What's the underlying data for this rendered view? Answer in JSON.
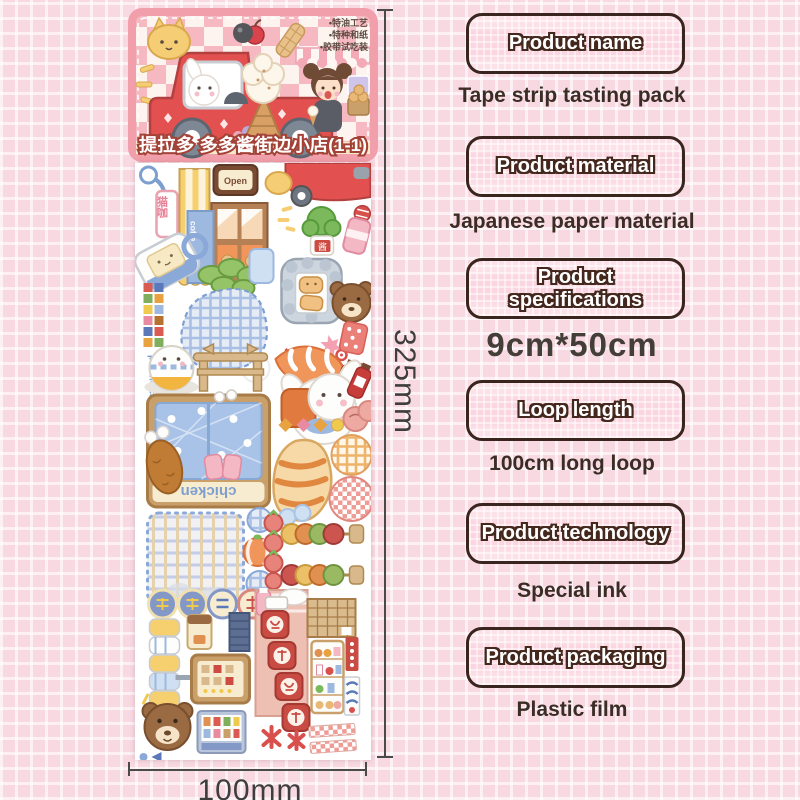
{
  "page": {
    "background": "#f8d9e2",
    "accent_pink": "#fbd6e0",
    "badge_border": "#3a241e",
    "text_brown": "#3b2d26"
  },
  "dimensions": {
    "height": "325mm",
    "width": "100mm"
  },
  "label_card": {
    "title": "提拉多 多多酱街边小店(1-1)",
    "features": {
      "line1": "•特油工艺",
      "line2": "•特种和纸",
      "line3": "•胶带试吃装"
    }
  },
  "strip_art": {
    "cat_cafe_sign": "猫咖",
    "open_sign": "Open",
    "coffee_sign": "coffe",
    "jar_label": "酱",
    "number_badge": "6",
    "pet_the_cat": "pet the cat",
    "chicken_banner": "chicken"
  },
  "specs": [
    {
      "label": "Product name",
      "value": "Tape strip tasting pack"
    },
    {
      "label": "Product material",
      "value": "Japanese paper material"
    },
    {
      "label": "Product specifications",
      "value": "9cm*50cm"
    },
    {
      "label": "Loop length",
      "value": "100cm long loop"
    },
    {
      "label": "Product technology",
      "value": "Special ink"
    },
    {
      "label": "Product packaging",
      "value": "Plastic film"
    }
  ]
}
